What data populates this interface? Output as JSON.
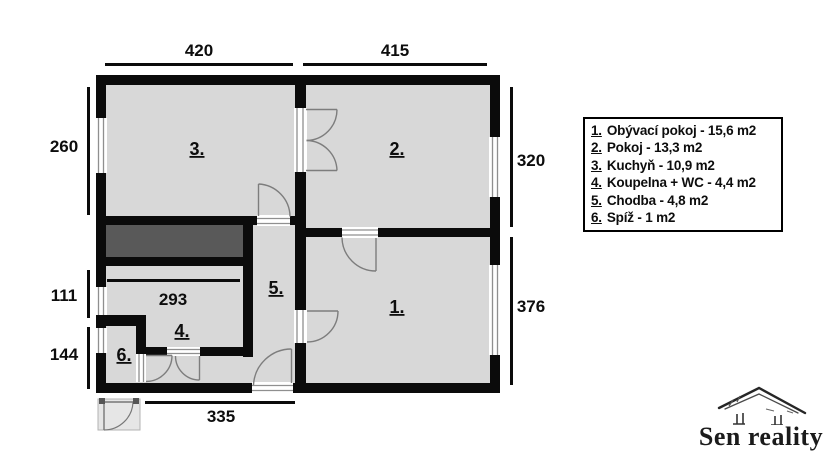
{
  "plan": {
    "room_labels": {
      "r1": "1.",
      "r2": "2.",
      "r3": "3.",
      "r4": "4.",
      "r5": "5.",
      "r6": "6."
    },
    "dimensions": {
      "top_left": "420",
      "top_right": "415",
      "left_top": "260",
      "left_middle": "111",
      "left_bottom": "144",
      "right_top": "320",
      "right_bottom": "376",
      "bottom": "335",
      "bathroom_width": "293"
    }
  },
  "legend": {
    "items": [
      {
        "num": "1.",
        "label": "Obývací pokoj - 15,6 m2"
      },
      {
        "num": "2.",
        "label": "Pokoj - 13,3 m2"
      },
      {
        "num": "3.",
        "label": "Kuchyň - 10,9 m2"
      },
      {
        "num": "4.",
        "label": "Koupelna + WC - 4,4 m2"
      },
      {
        "num": "5.",
        "label": "Chodba - 4,8 m2"
      },
      {
        "num": "6.",
        "label": "Spíž - 1 m2"
      }
    ]
  },
  "logo": {
    "name": "Sen reality"
  },
  "colors": {
    "wall": "#0b0b0b",
    "room_fill": "#d8d8d8",
    "dark_area": "#595959",
    "background": "#ffffff"
  }
}
